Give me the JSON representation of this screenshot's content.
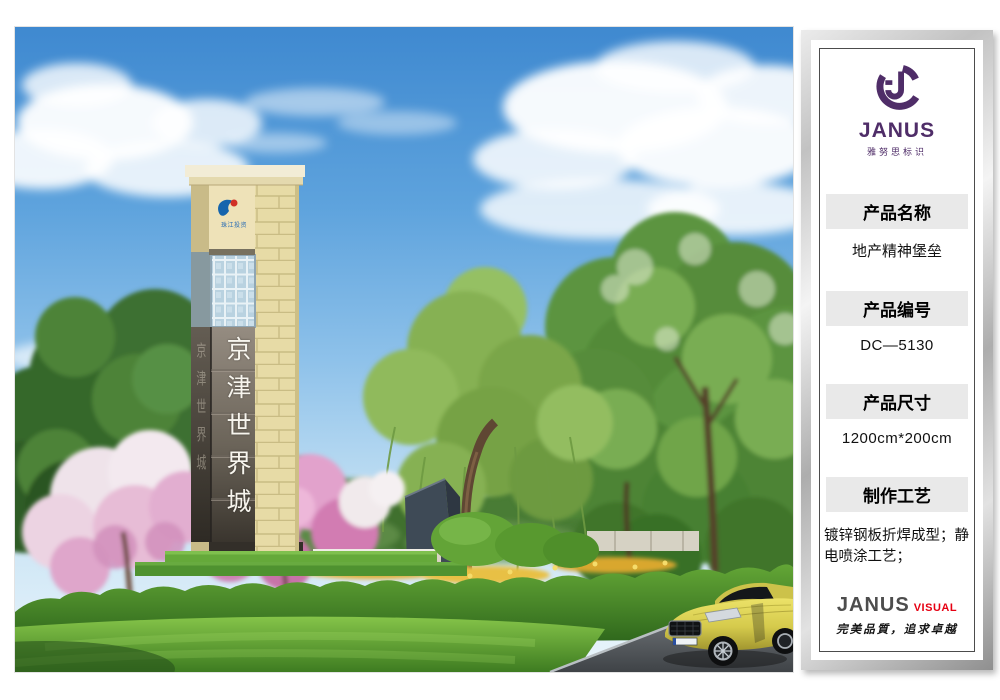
{
  "sidebar": {
    "logo": {
      "brand": "JANUS",
      "subtitle": "雅努思标识"
    },
    "sections": [
      {
        "label": "产品名称",
        "value": "地产精神堡垒"
      },
      {
        "label": "产品编号",
        "value": "DC—5130"
      },
      {
        "label": "产品尺寸",
        "value": "1200cm*200cm"
      },
      {
        "label": "制作工艺",
        "value": "镀锌钢板折焊成型；静电喷涂工艺；"
      }
    ],
    "footer": {
      "brand": "JANUS",
      "brand_suffix": "VISUAL",
      "slogan": "完美品質，追求卓越"
    }
  },
  "scene": {
    "tower": {
      "front_text_vertical": "京津世界城",
      "side_text_vertical": "京津世界城",
      "developer_logo_text": "珠江投资"
    }
  },
  "colors": {
    "brand_purple": "#4f2d68",
    "visual_red": "#e60012",
    "section_header_bg": "#e9e9e9",
    "sky_top": "#3f89d0",
    "stone_beige": "#e7dba6",
    "sign_panel_gray": "#6e665c",
    "car_yellow": "#d5ca4c"
  }
}
